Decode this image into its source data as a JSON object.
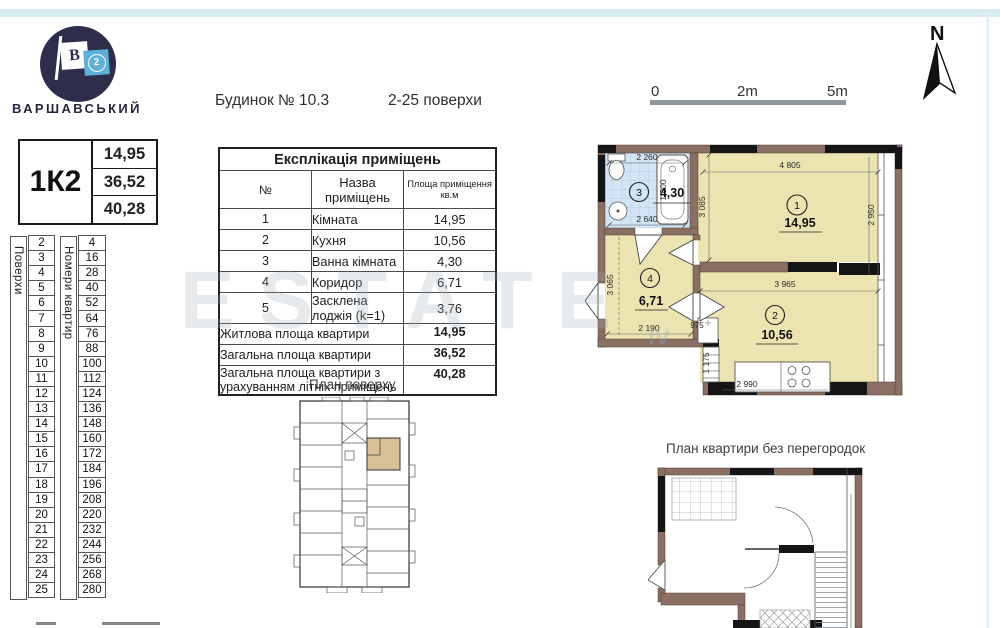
{
  "logo": {
    "name": "ВАРШАВСЬКИЙ",
    "flag_letter": "В",
    "flag_number": "2"
  },
  "unit_card": {
    "code": "1К2",
    "living_area": "14,95",
    "total_area": "36,52",
    "total_with_summer": "40,28"
  },
  "header": {
    "building": "Будинок № 10.3",
    "floors_range": "2-25 поверхи"
  },
  "floors_table": {
    "floors_label": "Поверхи",
    "numbers_label": "Номери квартир",
    "floors": [
      "2",
      "3",
      "4",
      "5",
      "6",
      "7",
      "8",
      "9",
      "10",
      "11",
      "12",
      "13",
      "14",
      "15",
      "16",
      "17",
      "18",
      "19",
      "20",
      "21",
      "22",
      "23",
      "24",
      "25"
    ],
    "numbers": [
      "4",
      "16",
      "28",
      "40",
      "52",
      "64",
      "76",
      "88",
      "100",
      "112",
      "124",
      "136",
      "148",
      "160",
      "172",
      "184",
      "196",
      "208",
      "220",
      "232",
      "244",
      "256",
      "268",
      "280"
    ]
  },
  "explication": {
    "title": "Експлікація приміщень",
    "col_num": "№",
    "col_name": "Назва приміщень",
    "col_area": "Площа приміщення кв.м",
    "rows": [
      {
        "num": "1",
        "name": "Кімната",
        "area": "14,95"
      },
      {
        "num": "2",
        "name": "Кухня",
        "area": "10,56"
      },
      {
        "num": "3",
        "name": "Ванна кімната",
        "area": "4,30"
      },
      {
        "num": "4",
        "name": "Коридор",
        "area": "6,71"
      },
      {
        "num": "5",
        "name": "Засклена лоджія (k=1)",
        "area": "3,76"
      }
    ],
    "totals": [
      {
        "name": "Житлова площа квартири",
        "area": "14,95"
      },
      {
        "name": "Загальна площа квартири",
        "area": "36,52"
      },
      {
        "name": "Загальна площа квартири з урахуванням літніх приміщень",
        "area": "40,28"
      }
    ]
  },
  "scale_bar": {
    "zero": "0",
    "mid": "2m",
    "end": "5m"
  },
  "compass": {
    "label": "N"
  },
  "plan_labels": {
    "floor_plan": "План поверху",
    "open_plan": "План квартири без перегородок"
  },
  "plan": {
    "rooms": {
      "r1": {
        "num": "1",
        "area": "14,95"
      },
      "r2": {
        "num": "2",
        "area": "10,56"
      },
      "r3": {
        "num": "3",
        "area": "4,30"
      },
      "r4": {
        "num": "4",
        "area": "6,71"
      }
    },
    "dims": {
      "bath_top": "2 260",
      "bath_bottom": "2 640",
      "bath_tub": "1 800",
      "room1_top": "4 805",
      "room1_left": "3 085",
      "room1_right": "2 950",
      "corridor_left": "3 065",
      "corridor_bottom": "2 190",
      "kitchen_top": "3 965",
      "kitchen_niche": "975",
      "kitchen_step": "1 175",
      "kitchen_counter": "2 990"
    }
  },
  "watermark": {
    "text": "ESTATE",
    "sub": "lv"
  }
}
